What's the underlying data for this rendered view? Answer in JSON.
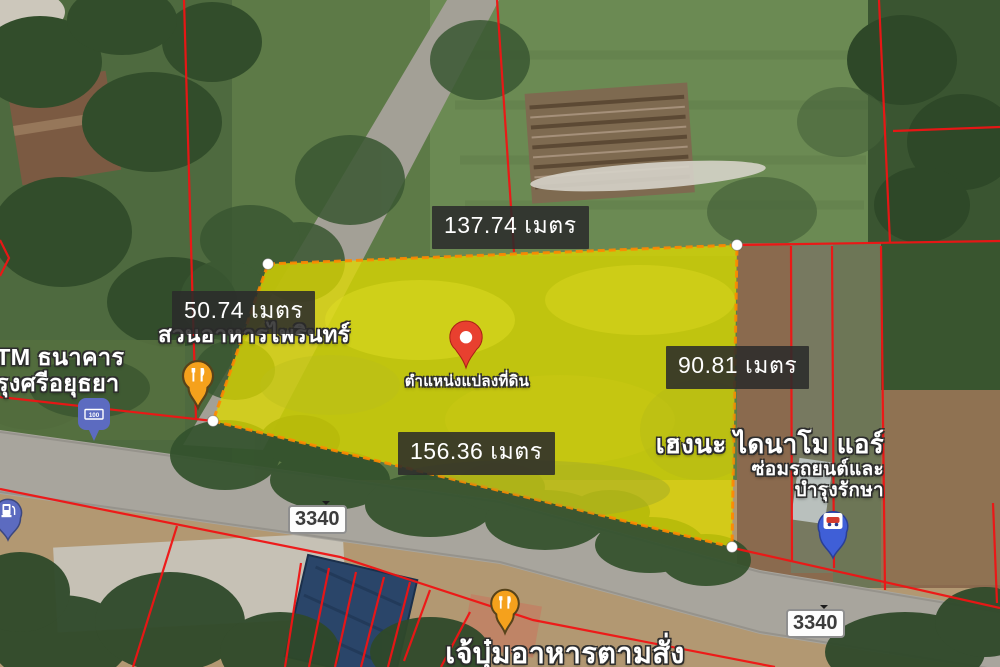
{
  "map": {
    "measurements": {
      "top": "137.74 เมตร",
      "left": "50.74 เมตร",
      "right": "90.81 เมตร",
      "bottom": "156.36 เมตร"
    },
    "plot_marker": {
      "label": "ตำแหน่งแปลงที่ดิน",
      "pin_color": "#e8402f",
      "plot_fill_color": "#d8d41c",
      "plot_outline_color": "#ff8800",
      "parcel_line_color": "#f01414"
    },
    "places": {
      "restaurant_north": {
        "name": "สวนอาหารไพรินทร์"
      },
      "bank_atm": {
        "name_line1": "TM ธนาคาร",
        "name_line2": "รุงศรีอยุธยา",
        "icon_text": "100"
      },
      "garage": {
        "name_line1": "เฮงนะ ไดนาโม แอร์",
        "name_line2": "ซ่อมรถยนต์และ",
        "name_line3": "บำรุงรักษา"
      },
      "restaurant_south": {
        "name": "เจ้บุ๋มอาหารตามสั่ง"
      }
    },
    "road_badges": {
      "west": "3340",
      "east": "3340"
    }
  }
}
